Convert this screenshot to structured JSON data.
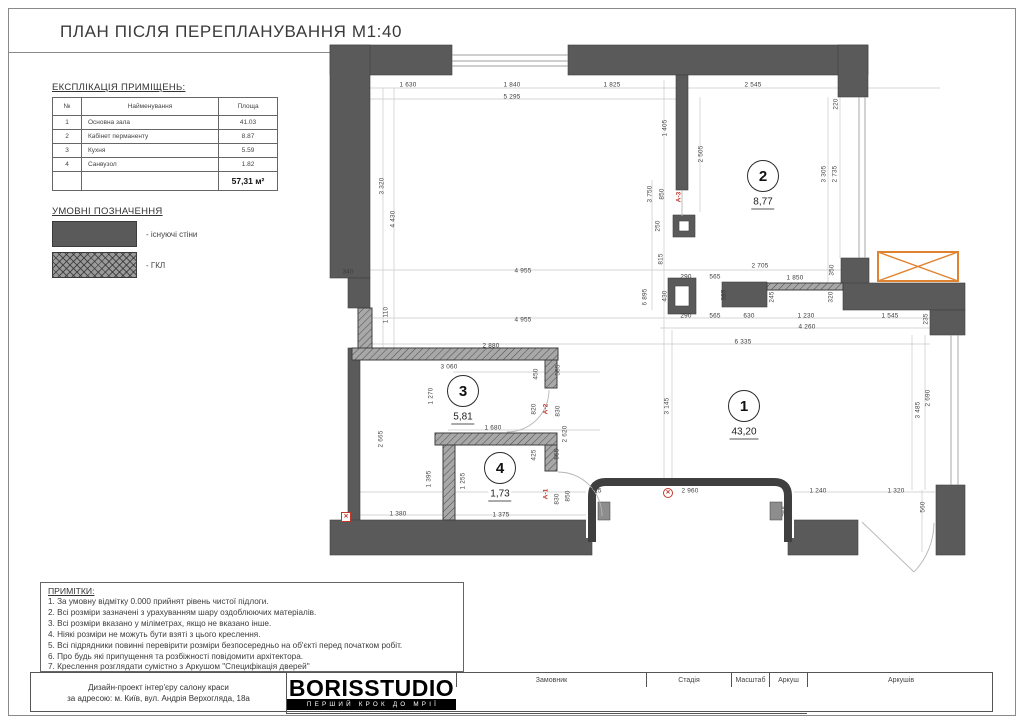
{
  "page": {
    "title": "ПЛАН ПІСЛЯ ПЕРЕПЛАНУВАННЯ М1:40"
  },
  "colors": {
    "wall": "#5a5a5a",
    "gkl_hatch": "#a8a8a8",
    "marker_orange": "#e0832f",
    "marker_red": "#c0392b"
  },
  "explication": {
    "heading": "ЕКСПЛІКАЦІЯ ПРИМІЩЕНЬ:",
    "columns": [
      "№",
      "Найменування",
      "Площа"
    ],
    "rows": [
      [
        "1",
        "Основна зала",
        "41.03"
      ],
      [
        "2",
        "Кабінет перманенту",
        "8.87"
      ],
      [
        "3",
        "Кухня",
        "5.59"
      ],
      [
        "4",
        "Санвузол",
        "1.82"
      ]
    ],
    "total": "57,31 м²"
  },
  "legend": {
    "heading": "УМОВНІ ПОЗНАЧЕННЯ",
    "items": [
      {
        "type": "solid",
        "label": "- існуючі стіни"
      },
      {
        "type": "hatch",
        "label": "- ГКЛ"
      }
    ]
  },
  "notes": {
    "heading": "ПРИМІТКИ:",
    "items": [
      "1. За умовну відмітку 0.000 прийнят рівень чистої підлоги.",
      "2. Всі розміри зазначені з урахуванням шару оздоблюючих матеріалів.",
      "3. Всі розміри вказано у міліметрах, якщо не вказано інше.",
      "4. Ніякі розміри не можуть бути взяті з цього креслення.",
      "5. Всі підрядники повинні перевірити розміри безпосередньо на об'єкті перед початком робіт.",
      "6. Про будь які припущення та розбіжності повідомити архітектора.",
      "7. Креслення розглядати сумістно з Аркушом \"Специфікація дверей\""
    ]
  },
  "titleblock": {
    "project_line1": "Дизайн-проект інтер'єру салону краси",
    "project_line2": "за адресою: м. Київ, вул. Андрія Верхогляда, 18а",
    "customer_label": "Замовник",
    "customer_value": "Головчик Ігор Олексійович",
    "stage_label": "Стадія",
    "stage_value": "ПЛАН ПІСЛЯ ПЕРЕПЛАНУВАННЯ",
    "scale_label": "Масштаб",
    "scale_value": "1:40",
    "sheet_label": "Аркуш",
    "sheet_value": "18",
    "sheets_label": "Аркушів",
    "sheets_value": "40",
    "logo_text": "BORISSTUDIO",
    "logo_tagline": "ПЕРШИЙ КРОК ДО МРІЇ"
  },
  "plan": {
    "rooms": [
      {
        "num": "1",
        "area": "43,20",
        "cx": 744,
        "cy": 406
      },
      {
        "num": "2",
        "area": "8,77",
        "cx": 763,
        "cy": 176
      },
      {
        "num": "3",
        "area": "5,81",
        "cx": 463,
        "cy": 391
      },
      {
        "num": "4",
        "area": "1,73",
        "cx": 500,
        "cy": 468
      }
    ],
    "door_labels": [
      {
        "t": "А-3",
        "x": 679,
        "y": 197
      },
      {
        "t": "А-2",
        "x": 546,
        "y": 409
      },
      {
        "t": "А-1",
        "x": 546,
        "y": 494
      }
    ],
    "markers": [
      {
        "type": "circle-x",
        "x": 668,
        "y": 493
      },
      {
        "type": "square-x",
        "x": 346,
        "y": 517
      }
    ],
    "dims": [
      {
        "t": "1 630",
        "x": 408,
        "y": 85
      },
      {
        "t": "1 840",
        "x": 512,
        "y": 85
      },
      {
        "t": "1 825",
        "x": 612,
        "y": 85
      },
      {
        "t": "2 545",
        "x": 753,
        "y": 85
      },
      {
        "t": "5 295",
        "x": 512,
        "y": 97
      },
      {
        "t": "220",
        "x": 836,
        "y": 104,
        "r": 1
      },
      {
        "t": "1 405",
        "x": 665,
        "y": 128,
        "r": 1
      },
      {
        "t": "2 505",
        "x": 701,
        "y": 154,
        "r": 1
      },
      {
        "t": "3 320",
        "x": 382,
        "y": 186,
        "r": 1
      },
      {
        "t": "4 430",
        "x": 393,
        "y": 219,
        "r": 1
      },
      {
        "t": "3 750",
        "x": 650,
        "y": 194,
        "r": 1
      },
      {
        "t": "850",
        "x": 662,
        "y": 194,
        "r": 1
      },
      {
        "t": "3 305",
        "x": 824,
        "y": 174,
        "r": 1
      },
      {
        "t": "2 735",
        "x": 835,
        "y": 174,
        "r": 1
      },
      {
        "t": "250",
        "x": 658,
        "y": 226,
        "r": 1
      },
      {
        "t": "815",
        "x": 661,
        "y": 259,
        "r": 1
      },
      {
        "t": "340",
        "x": 348,
        "y": 272
      },
      {
        "t": "4 955",
        "x": 523,
        "y": 271
      },
      {
        "t": "2 705",
        "x": 760,
        "y": 266
      },
      {
        "t": "290",
        "x": 686,
        "y": 277
      },
      {
        "t": "565",
        "x": 715,
        "y": 277
      },
      {
        "t": "1 850",
        "x": 795,
        "y": 278
      },
      {
        "t": "350",
        "x": 832,
        "y": 270,
        "r": 1
      },
      {
        "t": "6 895",
        "x": 645,
        "y": 297,
        "r": 1
      },
      {
        "t": "430",
        "x": 665,
        "y": 296,
        "r": 1
      },
      {
        "t": "385",
        "x": 724,
        "y": 295,
        "r": 1
      },
      {
        "t": "245",
        "x": 772,
        "y": 297,
        "r": 1
      },
      {
        "t": "320",
        "x": 831,
        "y": 297,
        "r": 1
      },
      {
        "t": "1 110",
        "x": 386,
        "y": 315,
        "r": 1
      },
      {
        "t": "4 955",
        "x": 523,
        "y": 320
      },
      {
        "t": "290",
        "x": 686,
        "y": 316
      },
      {
        "t": "565",
        "x": 715,
        "y": 316
      },
      {
        "t": "630",
        "x": 749,
        "y": 316
      },
      {
        "t": "1 230",
        "x": 806,
        "y": 316
      },
      {
        "t": "1 545",
        "x": 890,
        "y": 316
      },
      {
        "t": "235",
        "x": 926,
        "y": 319,
        "r": 1
      },
      {
        "t": "4 260",
        "x": 807,
        "y": 327
      },
      {
        "t": "6 335",
        "x": 743,
        "y": 342
      },
      {
        "t": "2 880",
        "x": 491,
        "y": 346
      },
      {
        "t": "3 060",
        "x": 449,
        "y": 367
      },
      {
        "t": "450",
        "x": 536,
        "y": 374,
        "r": 1
      },
      {
        "t": "585",
        "x": 558,
        "y": 370,
        "r": 1
      },
      {
        "t": "1 270",
        "x": 431,
        "y": 396,
        "r": 1
      },
      {
        "t": "3 145",
        "x": 667,
        "y": 406,
        "r": 1
      },
      {
        "t": "820",
        "x": 534,
        "y": 409,
        "r": 1
      },
      {
        "t": "830",
        "x": 558,
        "y": 411,
        "r": 1
      },
      {
        "t": "1 680",
        "x": 493,
        "y": 428
      },
      {
        "t": "2 620",
        "x": 565,
        "y": 434,
        "r": 1
      },
      {
        "t": "425",
        "x": 534,
        "y": 455,
        "r": 1
      },
      {
        "t": "555",
        "x": 557,
        "y": 454,
        "r": 1
      },
      {
        "t": "2 665",
        "x": 381,
        "y": 439,
        "r": 1
      },
      {
        "t": "1 395",
        "x": 429,
        "y": 479,
        "r": 1
      },
      {
        "t": "1 255",
        "x": 463,
        "y": 481,
        "r": 1
      },
      {
        "t": "3 485",
        "x": 918,
        "y": 410,
        "r": 1
      },
      {
        "t": "2 690",
        "x": 928,
        "y": 398,
        "r": 1
      },
      {
        "t": "830",
        "x": 557,
        "y": 499,
        "r": 1
      },
      {
        "t": "850",
        "x": 568,
        "y": 496,
        "r": 1
      },
      {
        "t": "815",
        "x": 596,
        "y": 491
      },
      {
        "t": "1 380",
        "x": 398,
        "y": 514
      },
      {
        "t": "1 375",
        "x": 501,
        "y": 515
      },
      {
        "t": "355",
        "x": 594,
        "y": 513,
        "r": 1
      },
      {
        "t": "355",
        "x": 785,
        "y": 511,
        "r": 1
      },
      {
        "t": "2 960",
        "x": 690,
        "y": 491
      },
      {
        "t": "1 240",
        "x": 818,
        "y": 491
      },
      {
        "t": "1 320",
        "x": 896,
        "y": 491
      },
      {
        "t": "560",
        "x": 923,
        "y": 507,
        "r": 1
      }
    ]
  }
}
